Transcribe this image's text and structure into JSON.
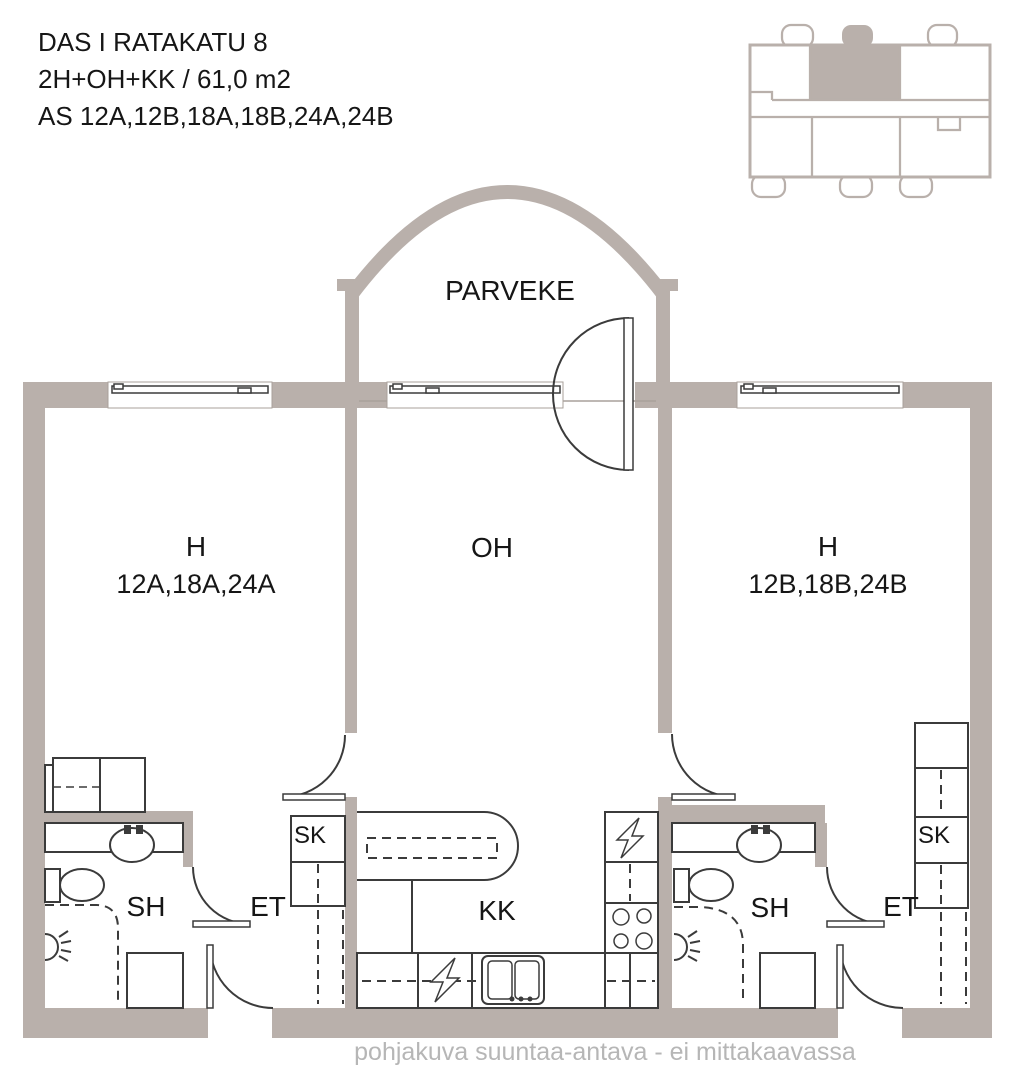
{
  "header": {
    "building": "DAS I RATAKATU 8",
    "layout": "2H+OH+KK / 61,0 m2",
    "apartments": "AS 12A,12B,18A,18B,24A,24B"
  },
  "plan": {
    "balcony_label": "PARVEKE",
    "room_left": {
      "label": "H",
      "apartments": "12A,18A,24A"
    },
    "living_room_label": "OH",
    "room_right": {
      "label": "H",
      "apartments": "12B,18B,24B"
    },
    "kitchen_label": "KK",
    "bath_left_label": "SH",
    "entry_left_label": "ET",
    "closet_left_label": "SK",
    "bath_right_label": "SH",
    "entry_right_label": "ET",
    "closet_right_label": "SK"
  },
  "footer": {
    "disclaimer": "pohjakuva suuntaa-antava - ei mittakaavassa"
  },
  "colors": {
    "wall": "#b9b0ab",
    "line": "#3b3b3b",
    "muted_text": "#b6b6b6"
  }
}
